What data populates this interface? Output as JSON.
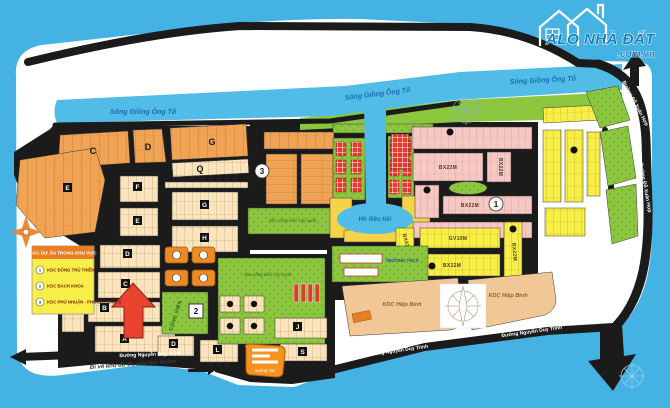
{
  "logo": {
    "title": "ALO NHÀ ĐẤT",
    "domain": ".com.vn"
  },
  "water": {
    "river": "Sông Giồng Ông Tố",
    "lake": "Hồ điều tiết"
  },
  "roads": {
    "nguyen_duy_trinh": "Đường Nguyễn Duy Trinh",
    "do_xuan_hop": "Đường Đỗ Xuân Hợp",
    "to_thu_thiem_note": "Đi về khu đô thị mới thủ thiêm"
  },
  "legend": {
    "title": "CÁC DỰ ÁN TRONG KHU VỰC",
    "items": [
      {
        "num": "1",
        "label": "KDC ĐÔNG THỦ THIÊM"
      },
      {
        "num": "2",
        "label": "KDC BÁCH KHOA"
      },
      {
        "num": "3",
        "label": "KDC PHÚ NHUẬN - PHƯỚC LONG B"
      }
    ]
  },
  "zones": {
    "bx22m": "BX22M",
    "gv10m": "GV10M",
    "kdc_hiep_binh": "KDC Hiệp Bình",
    "cong_vien": "CÔNG VIÊN",
    "khu_cong_vien": "khu công viên cây xanh",
    "truong_hoc": "trường học",
    "truong_thcs": "TRƯỜNG THCS"
  },
  "markers": {
    "m1": "1",
    "m2": "2",
    "m3": "3"
  },
  "blocks": {
    "a": "A",
    "b": "B",
    "c": "C",
    "d": "D",
    "e": "E",
    "f": "F",
    "g": "G",
    "h": "H",
    "j": "J",
    "l": "L",
    "q": "Q",
    "s": "S"
  }
}
